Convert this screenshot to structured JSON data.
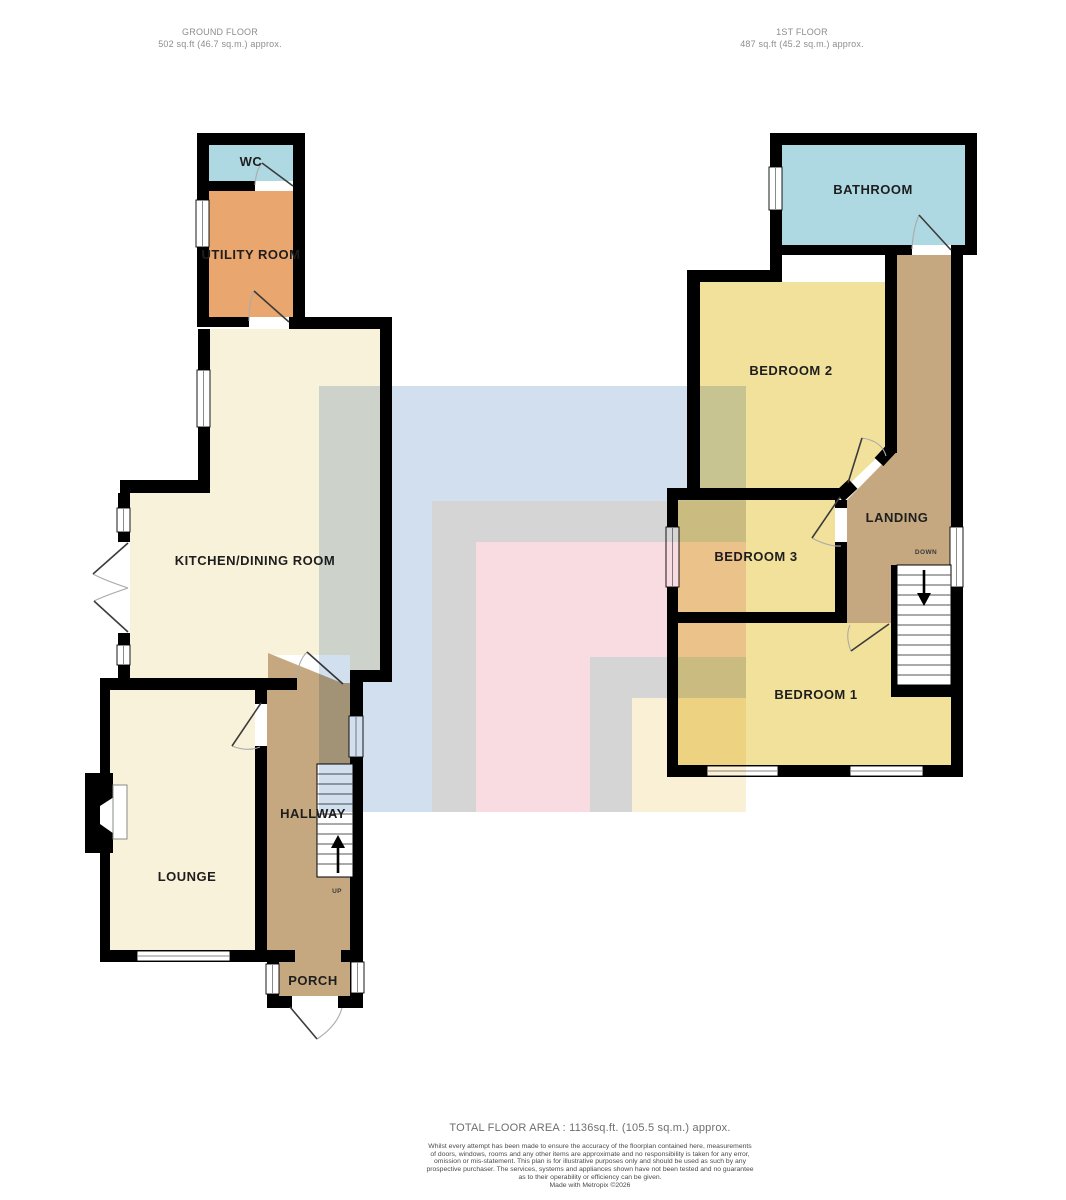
{
  "header": {
    "ground_title": "GROUND FLOOR",
    "ground_area": "502 sq.ft (46.7 sq.m.) approx.",
    "first_title": "1ST FLOOR",
    "first_area": "487 sq.ft (45.2 sq.m.) approx."
  },
  "ground_floor": {
    "rooms": {
      "wc": "WC",
      "utility": "UTILITY ROOM",
      "kitchen": "KITCHEN/DINING ROOM",
      "lounge": "LOUNGE",
      "hallway": "HALLWAY",
      "porch": "PORCH"
    },
    "stairs_label": "UP"
  },
  "first_floor": {
    "rooms": {
      "bathroom": "BATHROOM",
      "bedroom2": "BEDROOM 2",
      "bedroom3": "BEDROOM 3",
      "bedroom1": "BEDROOM 1",
      "landing": "LANDING"
    },
    "stairs_label": "DOWN"
  },
  "footer": {
    "total_area": "TOTAL FLOOR AREA : 1136sq.ft. (105.5 sq.m.) approx.",
    "disclaimer_lines": [
      "Whilst every attempt has been made to ensure the accuracy of the floorplan contained here, measurements",
      "of doors, windows, rooms and any other items are approximate and no responsibility is taken for any error,",
      "omission or mis-statement. This plan is for illustrative purposes only and should be used as such by any",
      "prospective purchaser. The services, systems and appliances shown have not been tested and no guarantee",
      "as to their operability or efficiency can be given."
    ],
    "credit": "Made with Metropix ©2026"
  },
  "colors": {
    "room_blue": "#aed9e2",
    "room_orange": "#e9a76f",
    "room_cream": "#f9f2da",
    "room_tan": "#c5a87f",
    "room_yellow": "#f2e19b",
    "wall": "#000000",
    "watermark_blue": "#d2dfee",
    "watermark_gray": "#d5d5d5",
    "watermark_pink": "#f8dce2",
    "watermark_cream": "#faf0d5"
  }
}
